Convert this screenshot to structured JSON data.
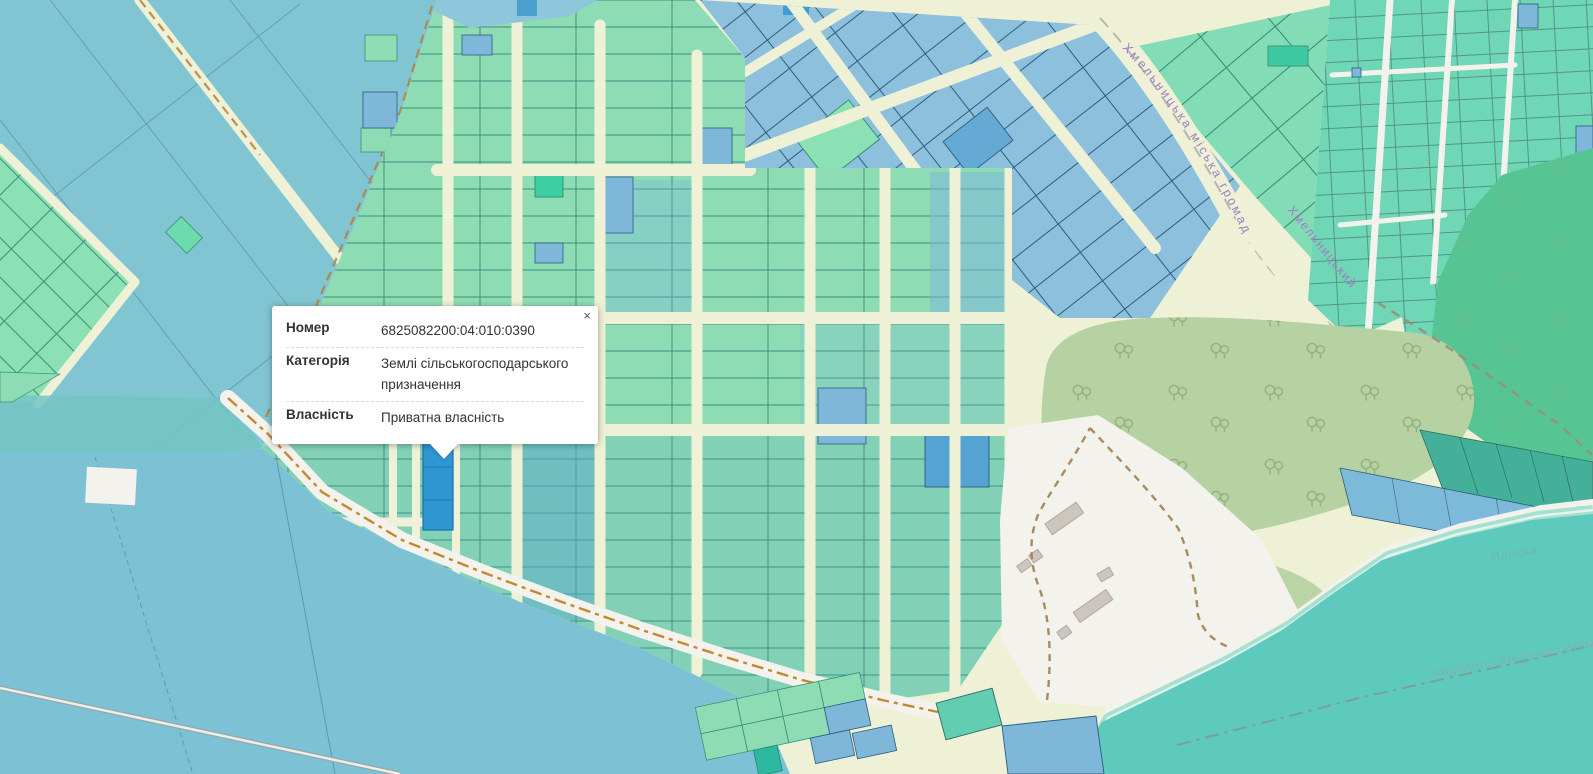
{
  "popup": {
    "close_label": "×",
    "rows": [
      {
        "label": "Номер",
        "value": "6825082200:04:010:0390"
      },
      {
        "label": "Категорія",
        "value": "Землі сільськогосподарського призначення"
      },
      {
        "label": "Власність",
        "value": "Приватна власність"
      }
    ]
  },
  "map_labels": {
    "road_main": "Хмельницька міська громада",
    "road_secondary": "Хмельницький",
    "river": "Плоска",
    "community": "Чорноострівська селищна гр"
  },
  "colors": {
    "selected_parcel": "#2e96d1",
    "parcel_green": "#8edcb4",
    "parcel_blue": "#8cc0dc",
    "parcel_teal_dense": "#6fd6b6",
    "road_cream": "#eff1d6",
    "road_white": "#f4f2ec",
    "fields_blue": "#80c5d1",
    "water_blue": "#7cc2d4",
    "water_teal": "#5ecabe",
    "forest_green": "#b6d2a2",
    "forest_dark_green": "#57c593",
    "boundary_dash_brown": "#b08338",
    "shore_dash_orange": "#c4892f",
    "road_label_purple": "#9d80c1",
    "water_label_teal": "#74b4ac"
  }
}
